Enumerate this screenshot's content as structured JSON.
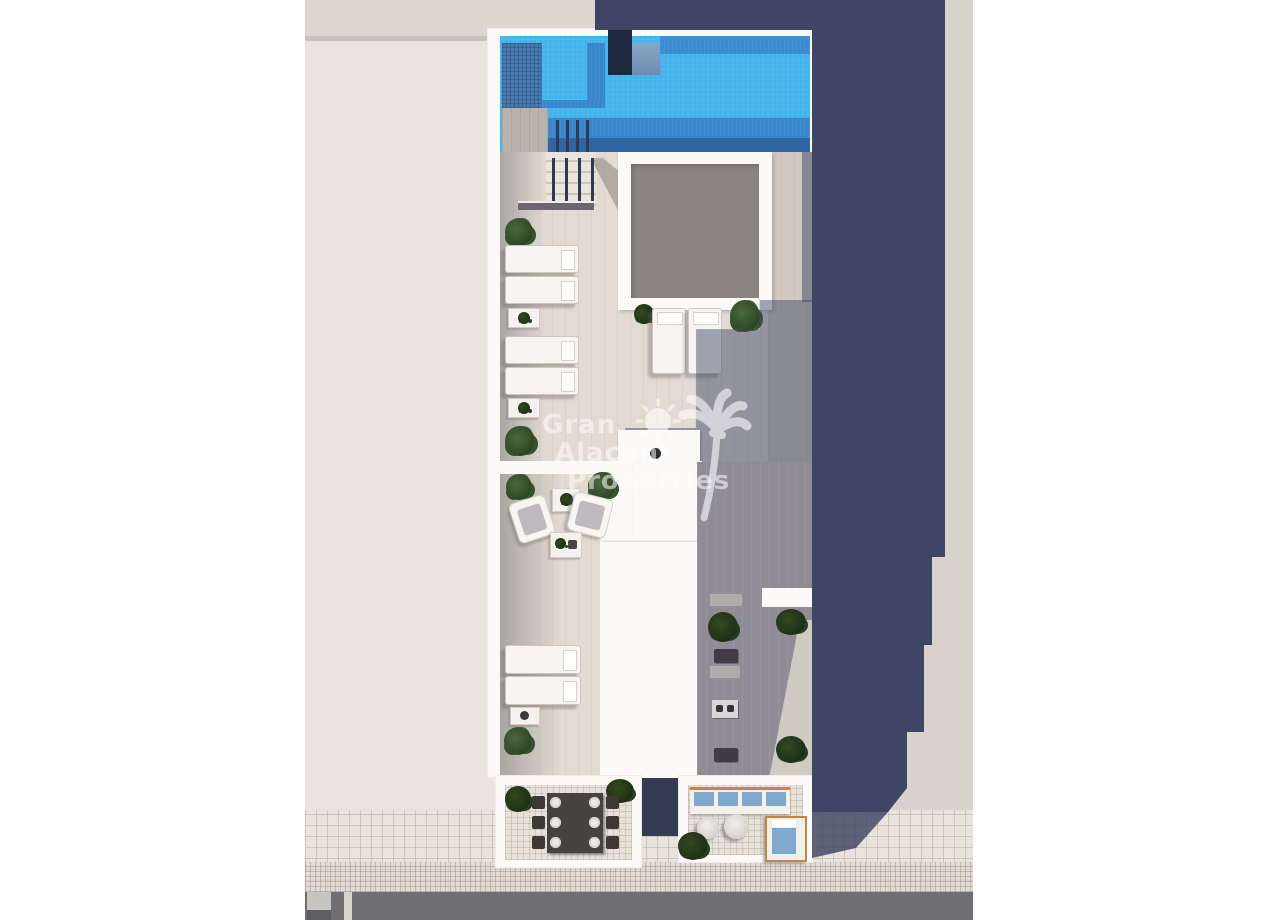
{
  "watermark": {
    "line1": "Gran",
    "line2": "Alacant",
    "line3": "Properties"
  },
  "icons": {
    "sun": "sun-icon",
    "palm": "palm-tree-icon"
  },
  "colors": {
    "shadow_navy": "#3e4565",
    "ground_right": "#d7d3cc",
    "neighbor_beige": "#e9e5de",
    "neighbor_band": "#dcd8d0",
    "building_white": "#fbfaf8",
    "pool_water": "#45b7ec",
    "pool_mid": "#3a86cd",
    "pool_dark": "#2e66a4",
    "pool_tile_shadow": "#4679ad",
    "shower_dark": "#1e2840",
    "skylight_gray": "#8a8580",
    "floor_light": "#e1dbd2",
    "floor_right_strip": "#cfc9bf",
    "floor_shadowed": "#8f8c96",
    "sidewalk": "#e8e4db",
    "road": "#6f6e72",
    "wood_trim": "#c08549",
    "cushion_blue": "#7fa9cc",
    "watermark_white": "#ffffff"
  }
}
